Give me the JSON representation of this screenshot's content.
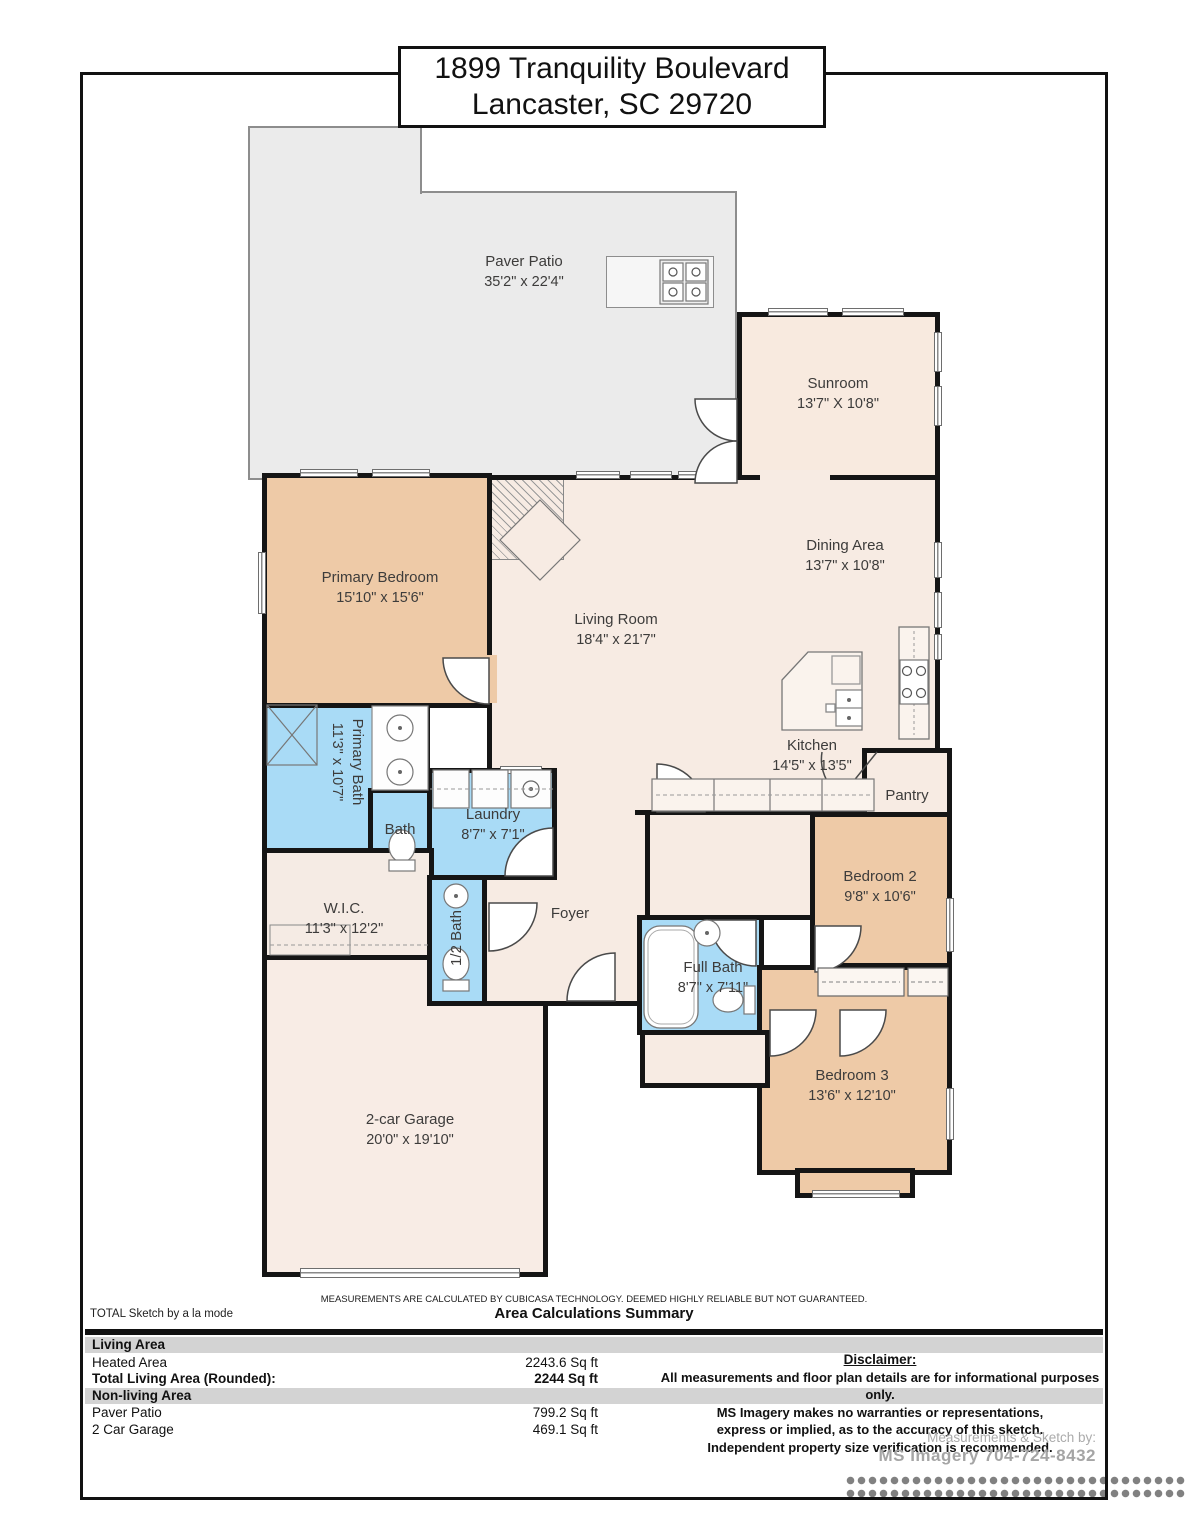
{
  "title": {
    "line1": "1899 Tranquility Boulevard",
    "line2": "Lancaster, SC 29720"
  },
  "rooms": [
    {
      "name": "Paver Patio",
      "dims": "35'2\" x 22'4\""
    },
    {
      "name": "Sunroom",
      "dims": "13'7\" X 10'8\""
    },
    {
      "name": "Dining Area",
      "dims": "13'7\" x 10'8\""
    },
    {
      "name": "Living Room",
      "dims": "18'4\" x 21'7\""
    },
    {
      "name": "Primary Bedroom",
      "dims": "15'10\" x 15'6\""
    },
    {
      "name": "Kitchen",
      "dims": "14'5\" x 13'5\""
    },
    {
      "name": "Pantry",
      "dims": ""
    },
    {
      "name": "Primary Bath",
      "dims": "11'3\" x 10'7\""
    },
    {
      "name": "Bath",
      "dims": ""
    },
    {
      "name": "Laundry",
      "dims": "8'7\" x 7'1\""
    },
    {
      "name": "W.I.C.",
      "dims": "11'3\" x 12'2\""
    },
    {
      "name": "1/2 Bath",
      "dims": ""
    },
    {
      "name": "Foyer",
      "dims": ""
    },
    {
      "name": "Full Bath",
      "dims": "8'7\" x 7'11\""
    },
    {
      "name": "Bedroom 2",
      "dims": "9'8\" x 10'6\""
    },
    {
      "name": "Bedroom 3",
      "dims": "13'6\" x 12'10\""
    },
    {
      "name": "2-car Garage",
      "dims": "20'0\" x 19'10\""
    }
  ],
  "footer": {
    "note": "MEASUREMENTS ARE CALCULATED BY CUBICASA TECHNOLOGY. DEEMED HIGHLY RELIABLE BUT NOT GUARANTEED.",
    "sketch_brand": "TOTAL Sketch by a la mode",
    "summary_title": "Area Calculations Summary",
    "sections": [
      {
        "header": "Living Area"
      },
      {
        "header": "Non-living Area"
      }
    ],
    "rows": [
      {
        "label": "Heated Area",
        "value": "2243.6 Sq ft"
      },
      {
        "label": "Total Living Area (Rounded):",
        "value": "2244 Sq ft"
      },
      {
        "label": "Paver Patio",
        "value": "799.2 Sq ft"
      },
      {
        "label": "2 Car Garage",
        "value": "469.1 Sq ft"
      }
    ],
    "disclaimer": {
      "title": "Disclaimer:",
      "line1": "All measurements and floor plan details are for informational purposes only.",
      "line2": "MS Imagery makes no warranties or representations,",
      "line3": "express or implied, as to the accuracy of this sketch.",
      "line4": "Independent property size verification is recommended.",
      "credit_label": "Measurements & Sketch by:",
      "credit_name": "MS Imagery 704-724-8432"
    }
  },
  "colors": {
    "wall": "#151515",
    "patio_floor": "#ebebeb",
    "living_floor": "#f7ebe3",
    "bedroom_floor": "#eecaa7",
    "bath_floor": "#a9dbf6",
    "garage_floor": "#f8ece5",
    "sunroom_floor": "#f8eadf",
    "band_gray": "#d3d3d3"
  }
}
